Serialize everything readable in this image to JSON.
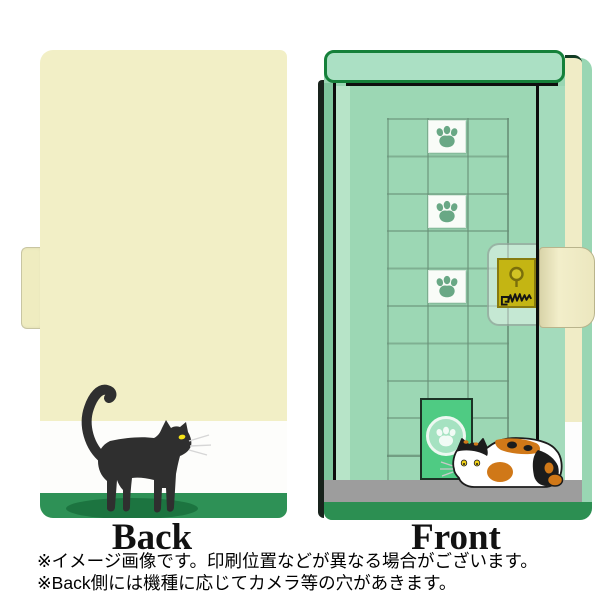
{
  "product": {
    "description": "notebook-style phone case with cat and door illustration, back and front views",
    "views": {
      "back": {
        "label": "Back"
      },
      "front": {
        "label": "Front"
      }
    }
  },
  "footnotes": [
    "※イメージ画像です。印刷位置などが異なる場合がございます。",
    "※Back側には機種に応じてカメラ等の穴があきます。"
  ],
  "colors": {
    "cover_cream": "#f2efc6",
    "band_white": "#fdfdfb",
    "band_green": "#2e9156",
    "front_green": "#9cd7b4",
    "top_bar_green": "#abe0c4",
    "top_bar_border": "#15803a",
    "cat_flap_green": "#4fcb83",
    "lock_gold": "#c4b513",
    "floor_gray": "#9d9d9d",
    "base_green": "#2c8f52",
    "cat_black": "#2f2f2f",
    "eye_yellow": "#f5e318",
    "calico_orange": "#d07818"
  },
  "icons": [
    "paw-print-icon",
    "keyhole-icon",
    "scratch-mark-icon"
  ]
}
